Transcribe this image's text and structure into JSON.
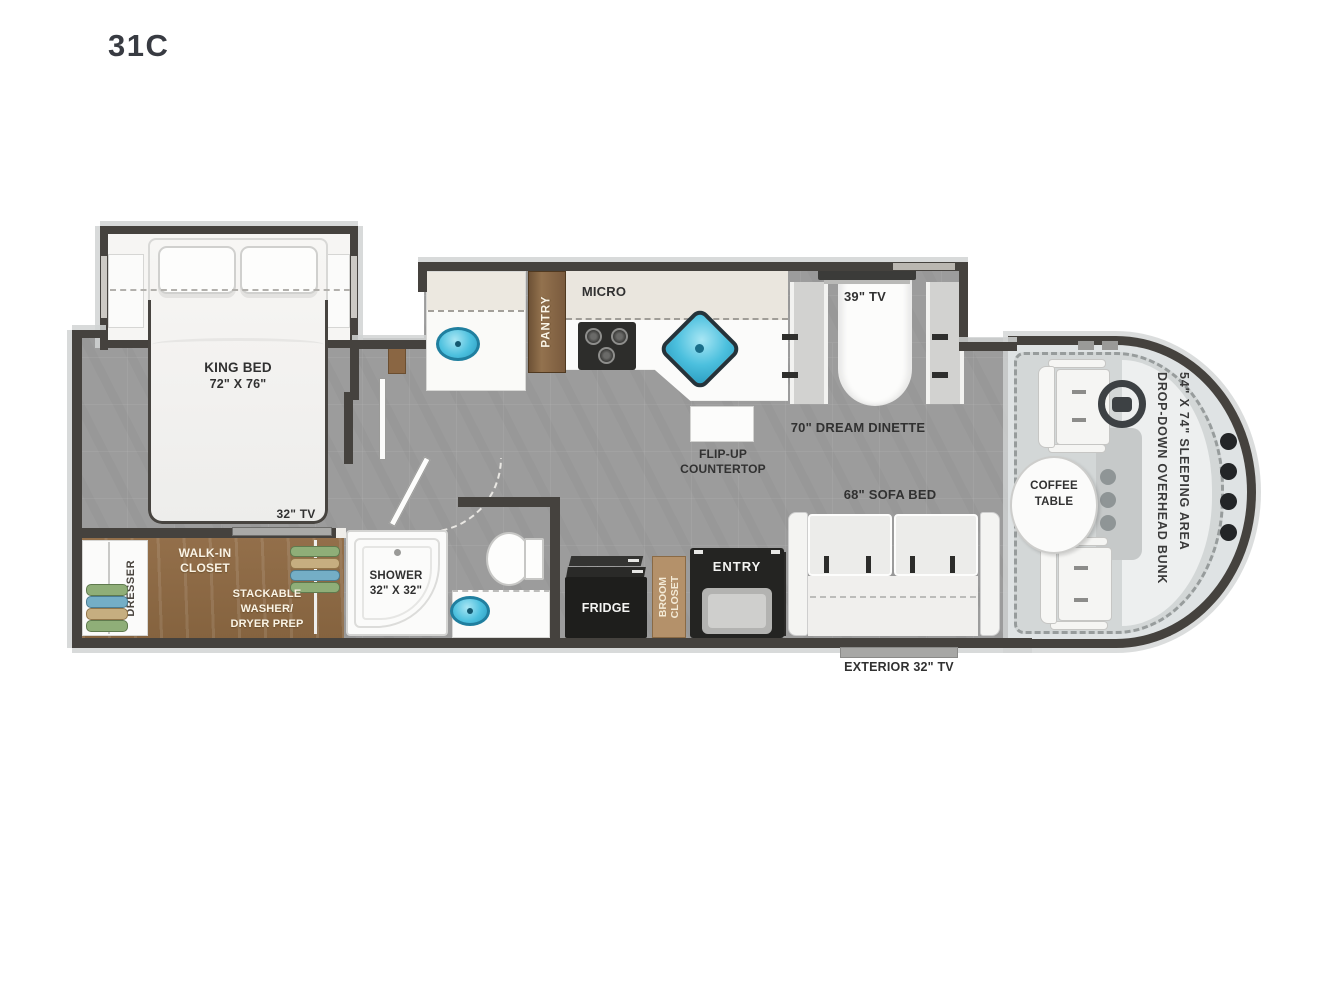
{
  "title": "31C",
  "colors": {
    "floor_gray": "#9c9c9c",
    "wall_dark": "#45423e",
    "closet_wood": "#8d6a46",
    "pantry_wood": "#7d5c3c",
    "broom_tan": "#b4916a",
    "sink_fill": "#4cc0de",
    "sink_rim": "#207f9f",
    "overhead_cabinet_cream": "#eae6de",
    "cab_floor_light": "#dfe3e4",
    "label_dark": "#313131"
  },
  "bedroom": {
    "bed_line1": "KING BED",
    "bed_line2": "72\" X 76\"",
    "tv_label": "32\" TV"
  },
  "closet": {
    "dresser": "DRESSER",
    "name_line1": "WALK-IN",
    "name_line2": "CLOSET",
    "washer_line1": "STACKABLE",
    "washer_line2": "WASHER/",
    "washer_line3": "DRYER PREP"
  },
  "bathroom": {
    "shower_line1": "SHOWER",
    "shower_line2": "32\" X 32\""
  },
  "kitchen": {
    "pantry": "PANTRY",
    "micro": "MICRO",
    "flip_line1": "FLIP-UP",
    "flip_line2": "COUNTERTOP"
  },
  "dinette": {
    "tv_label": "39\" TV",
    "name": "70\" DREAM DINETTE"
  },
  "living": {
    "sofa": "68\" SOFA BED",
    "exterior_tv": "EXTERIOR 32\" TV"
  },
  "entry": {
    "fridge": "FRIDGE",
    "broom_line1": "BROOM",
    "broom_line2": "CLOSET",
    "door": "ENTRY"
  },
  "cab": {
    "coffee_line1": "COFFEE",
    "coffee_line2": "TABLE",
    "bunk_line1": "DROP-DOWN OVERHEAD BUNK",
    "bunk_line2": "54\" X 74\" SLEEPING AREA"
  }
}
